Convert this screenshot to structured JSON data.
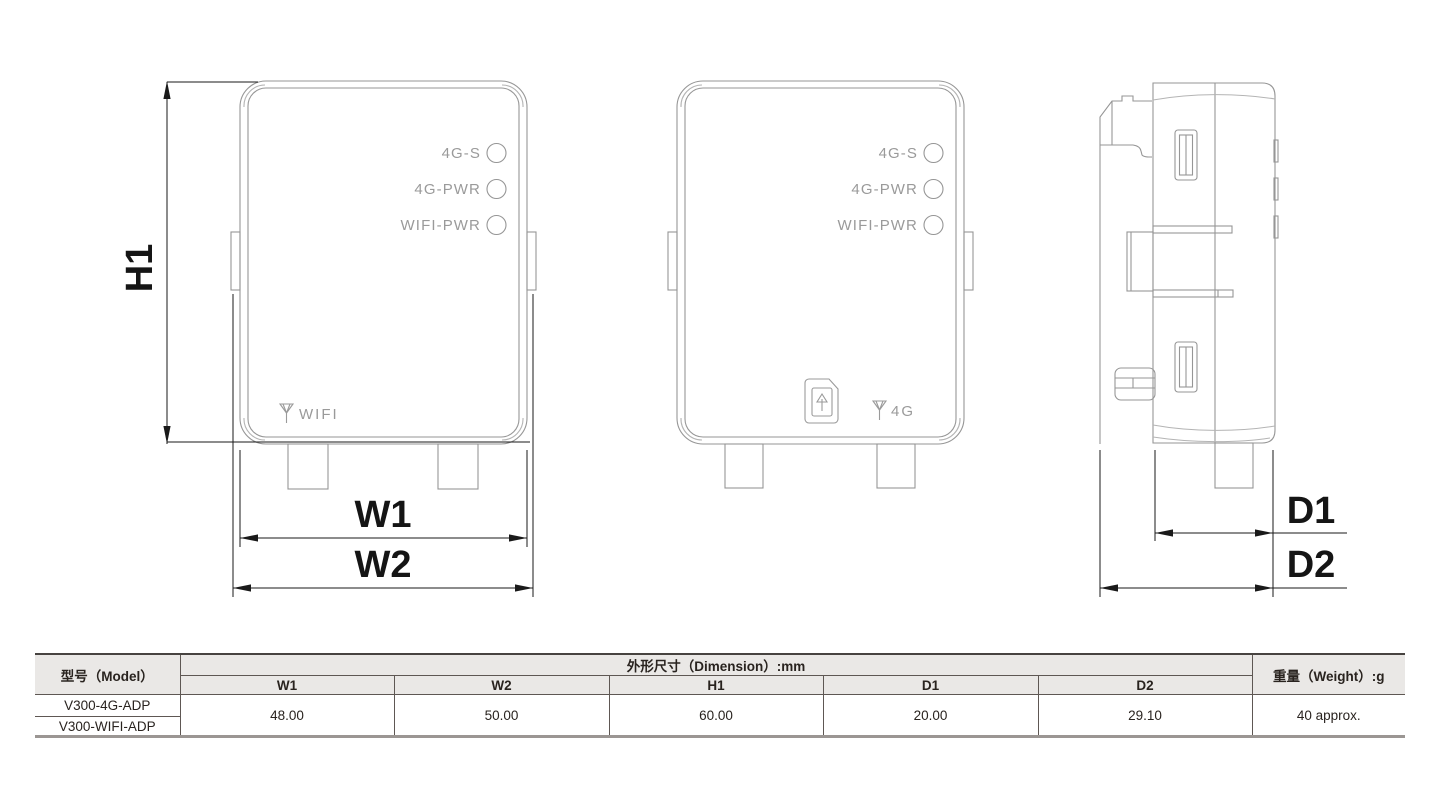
{
  "views": {
    "led_labels": [
      "4G-S",
      "4G-PWR",
      "WIFI-PWR"
    ],
    "front_left_antenna_label": "WIFI",
    "front_mid_antenna_label": "4G"
  },
  "dims": {
    "h1": "H1",
    "w1": "W1",
    "w2": "W2",
    "d1": "D1",
    "d2": "D2"
  },
  "table": {
    "model_header": "型号（Model）",
    "dimension_header": "外形尺寸（Dimension）:mm",
    "weight_header": "重量（Weight）:g",
    "columns": [
      "W1",
      "W2",
      "H1",
      "D1",
      "D2"
    ],
    "models": [
      "V300-4G-ADP",
      "V300-WIFI-ADP"
    ],
    "values": [
      "48.00",
      "50.00",
      "60.00",
      "20.00",
      "29.10"
    ],
    "weight": "40 approx."
  }
}
